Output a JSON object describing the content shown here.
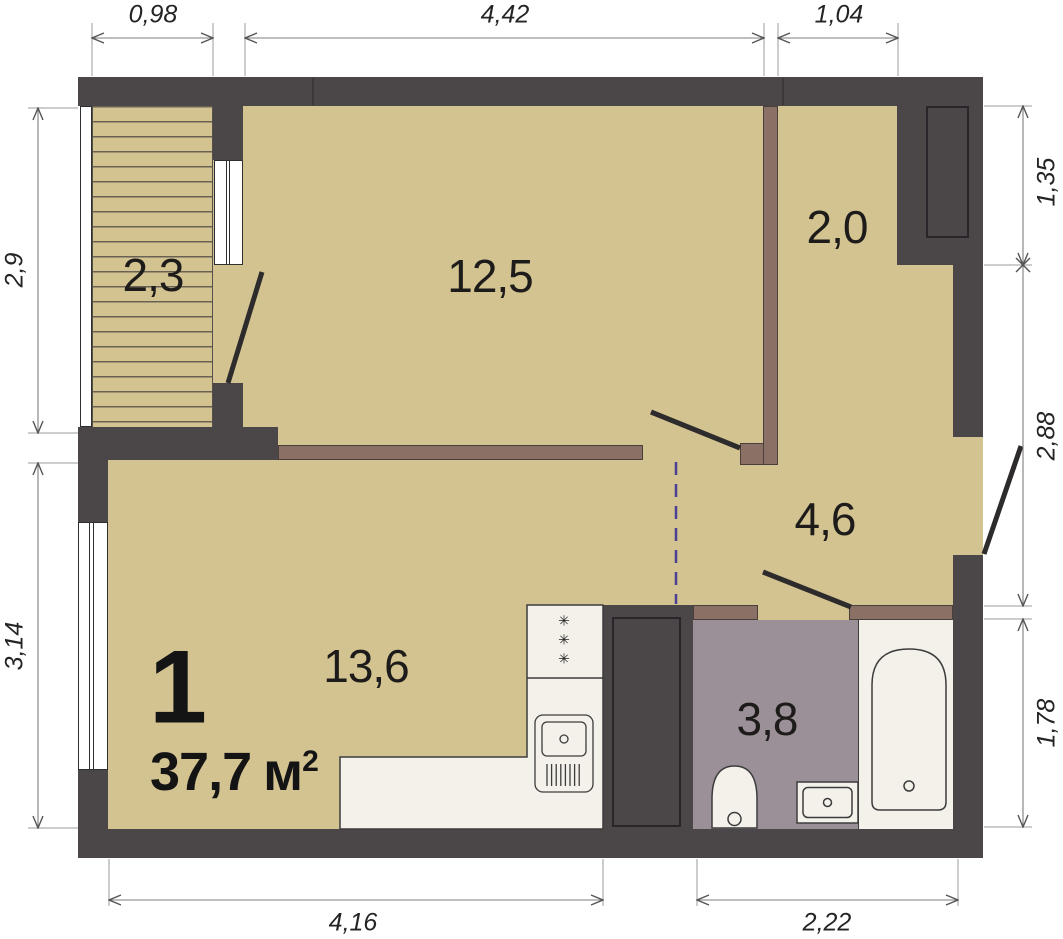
{
  "plan_title": {
    "unit_number": "1",
    "area_value": "37,7",
    "area_unit": "м",
    "area_exponent": "2"
  },
  "rooms": {
    "balcony": {
      "area": "2,3"
    },
    "living": {
      "area": "12,5"
    },
    "wardrobe": {
      "area": "2,0"
    },
    "hall": {
      "area": "4,6"
    },
    "kitchen": {
      "area": "13,6"
    },
    "bathroom": {
      "area": "3,8"
    }
  },
  "dimensions": {
    "top_balcony": "0,98",
    "top_living": "4,42",
    "top_wardrobe": "1,04",
    "left_balcony": "2,9",
    "left_kitchen": "3,14",
    "right_niche": "1,35",
    "right_hall": "2,88",
    "right_bathroom": "1,78",
    "bottom_kitchen": "4,16",
    "bottom_bathroom": "2,22"
  },
  "kitchen_fixtures": {
    "burner_symbols": "✳\n✳\n✳"
  },
  "colors": {
    "wall": "#4b4648",
    "floor": "#d3c391",
    "partition": "#8a7065",
    "wet_floor": "#9b9097",
    "fixture": "#f4f1ea",
    "zoning_line": "#4b3f96",
    "dimension_line": "#7d7d7d"
  }
}
